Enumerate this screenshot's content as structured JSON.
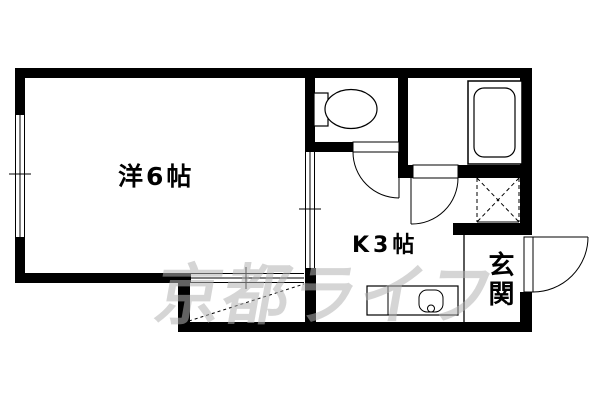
{
  "floorplan": {
    "background_color": "#ffffff",
    "wall_color": "#000000",
    "rooms": {
      "western_room": {
        "label": "洋6帖"
      },
      "kitchen": {
        "label": "K3帖"
      },
      "entrance": {
        "label": "玄関"
      }
    },
    "watermark": {
      "text": "京都ライフ",
      "color": "#b2b2b2"
    },
    "fixtures": {
      "toilet": "toilet-icon",
      "bathtub": "bathtub-icon",
      "kitchen_sink": "kitchen-sink-counter-icon",
      "washing_machine_space": "washing-machine-space-dashed-x",
      "windows": "sliding-window-symbol",
      "doors": "swing-door-symbol"
    }
  }
}
